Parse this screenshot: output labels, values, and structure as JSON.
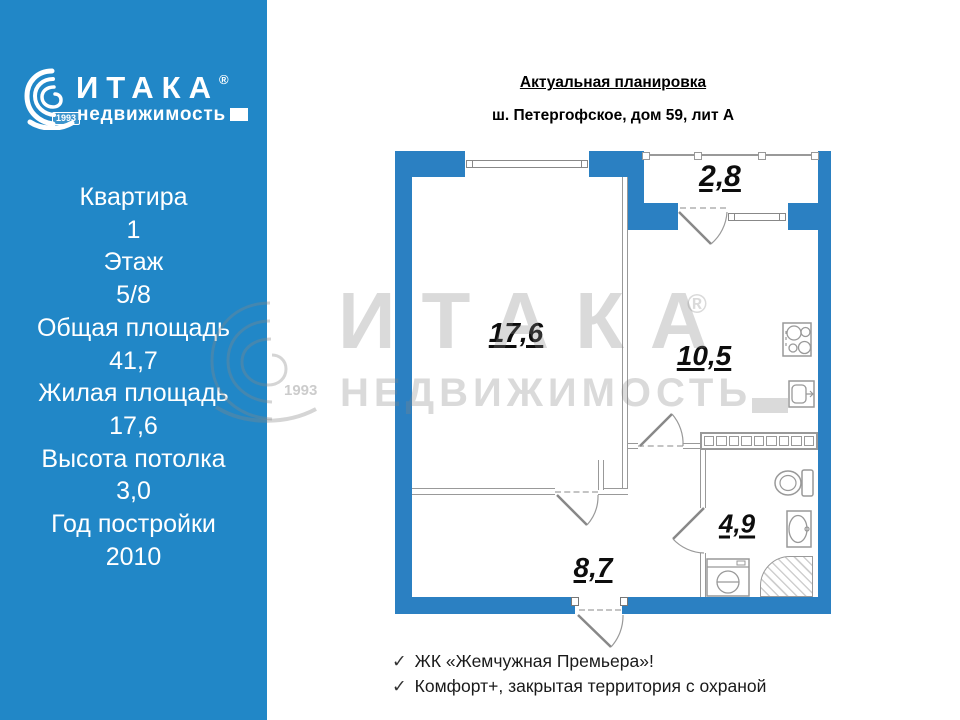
{
  "sidebar": {
    "logo": {
      "brand": "ИТАКА",
      "reg": "®",
      "sub": "недвижимость",
      "year": "1993"
    },
    "lines": [
      "Квартира",
      "1",
      "Этаж",
      "5/8",
      "Общая площадь",
      "41,7",
      "Жилая площадь",
      "17,6",
      "Высота потолка",
      "3,0",
      "Год постройки",
      "2010"
    ]
  },
  "header": {
    "title": "Актуальная планировка",
    "subtitle": "ш. Петергофское, дом 59, лит А"
  },
  "plan": {
    "areas": {
      "balcony": "2,8",
      "living": "17,6",
      "kitchen": "10,5",
      "hall": "8,7",
      "bath": "4,9"
    }
  },
  "watermark": {
    "brand": "ИТАКА",
    "reg": "®",
    "sub": "НЕДВИЖИМОСТЬ",
    "year": "1993"
  },
  "features": {
    "check": "✓",
    "items": [
      "ЖК «Жемчужная Премьера»!",
      "Комфорт+, закрытая территория с  охраной"
    ]
  },
  "colors": {
    "sidebar_blue": "#2187C7",
    "wall_blue": "#2B80C2"
  }
}
